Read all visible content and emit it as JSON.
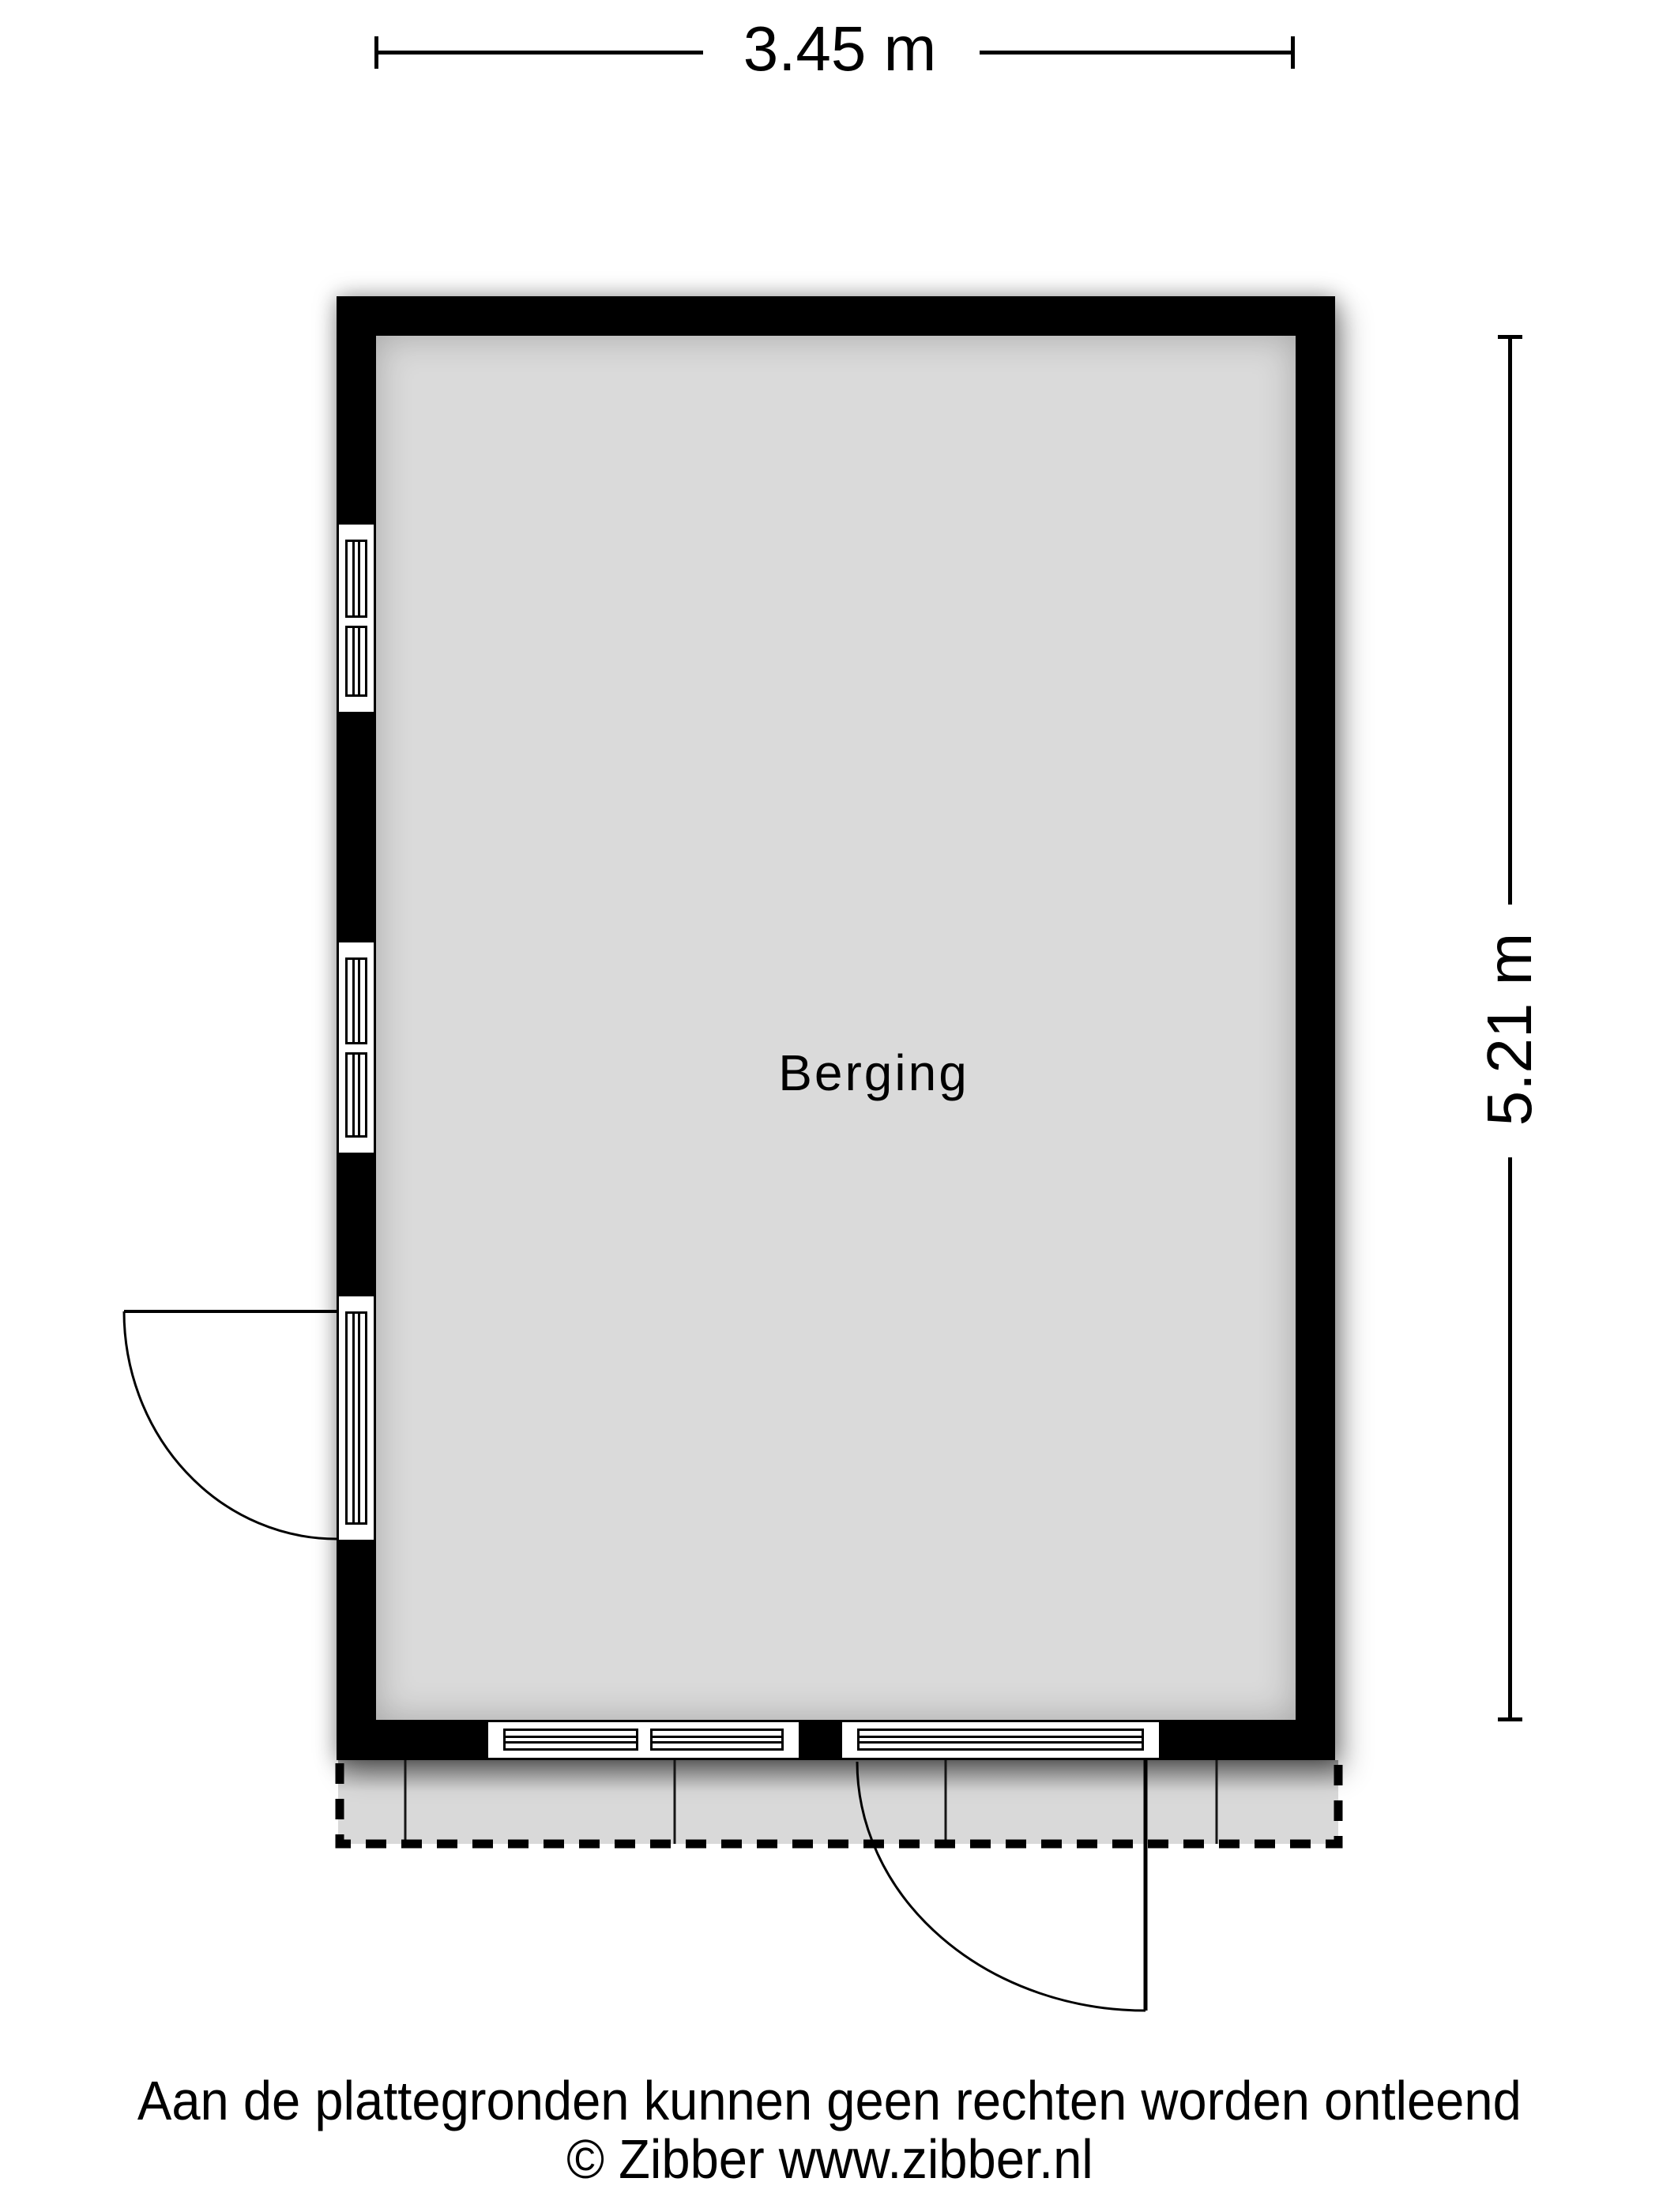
{
  "floorplan": {
    "room_label": "Berging",
    "width_dimension": "3.45 m",
    "height_dimension": "5.21 m"
  },
  "footer": {
    "disclaimer": "Aan de plattegronden kunnen geen rechten worden ontleend",
    "copyright": "© Zibber www.zibber.nl"
  },
  "colors": {
    "wall": "#000000",
    "floor": "#dadada",
    "terrace": "#d9d9d9",
    "background": "#ffffff",
    "line": "#000000"
  }
}
